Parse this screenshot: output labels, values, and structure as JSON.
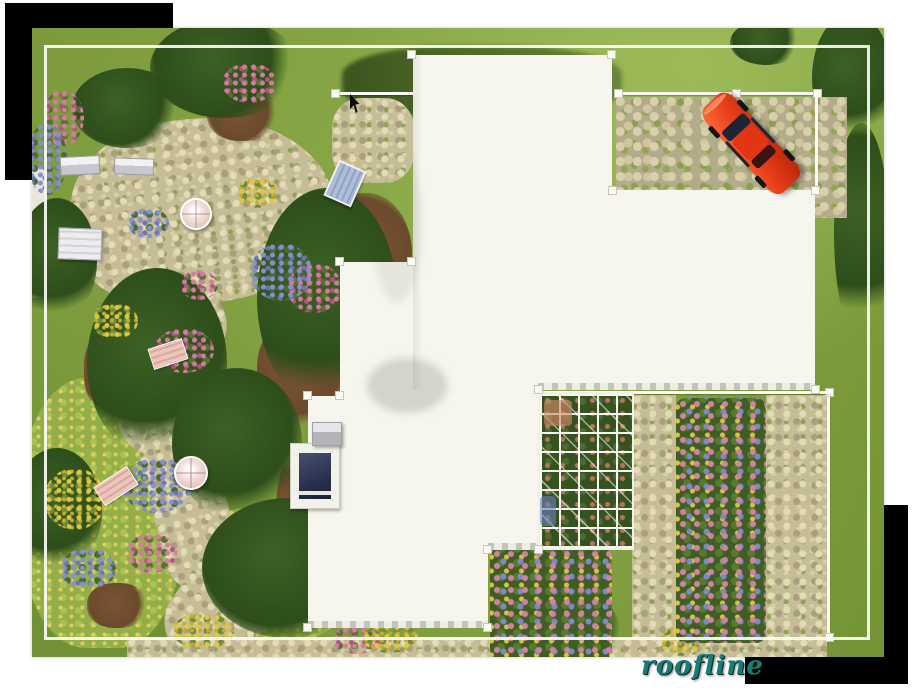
{
  "caption": {
    "text": "roofline",
    "color": "#157d75"
  },
  "decor": {
    "page_background": "#ffffff",
    "black_rect_color": "#000000"
  },
  "photo": {
    "frame_color": "#fbfbf6",
    "colors": {
      "grass": "#84a242",
      "foliage": "#2f501d",
      "stone": "#c6bd97",
      "mulch": "#6e4c2d",
      "roof": "#f6f5ee",
      "fence": "#fbfbf3",
      "car_body": "#ea3f1b",
      "car_window": "#1e2434",
      "skylight": "#2d3350",
      "flower_pink": "#c96f94",
      "flower_blue": "#7c86c8",
      "flower_yellow": "#d9c33c"
    },
    "objects": [
      "white-flat-roof",
      "skylight",
      "chimney-vent",
      "red-classic-car",
      "stone-driveway",
      "lot-fence",
      "garden-pergola-trellis",
      "flower-beds",
      "stone-paths",
      "patio-umbrella-tables",
      "garden-benches",
      "white-planter-boxes",
      "lawn-and-trees",
      "mouse-cursor"
    ]
  }
}
